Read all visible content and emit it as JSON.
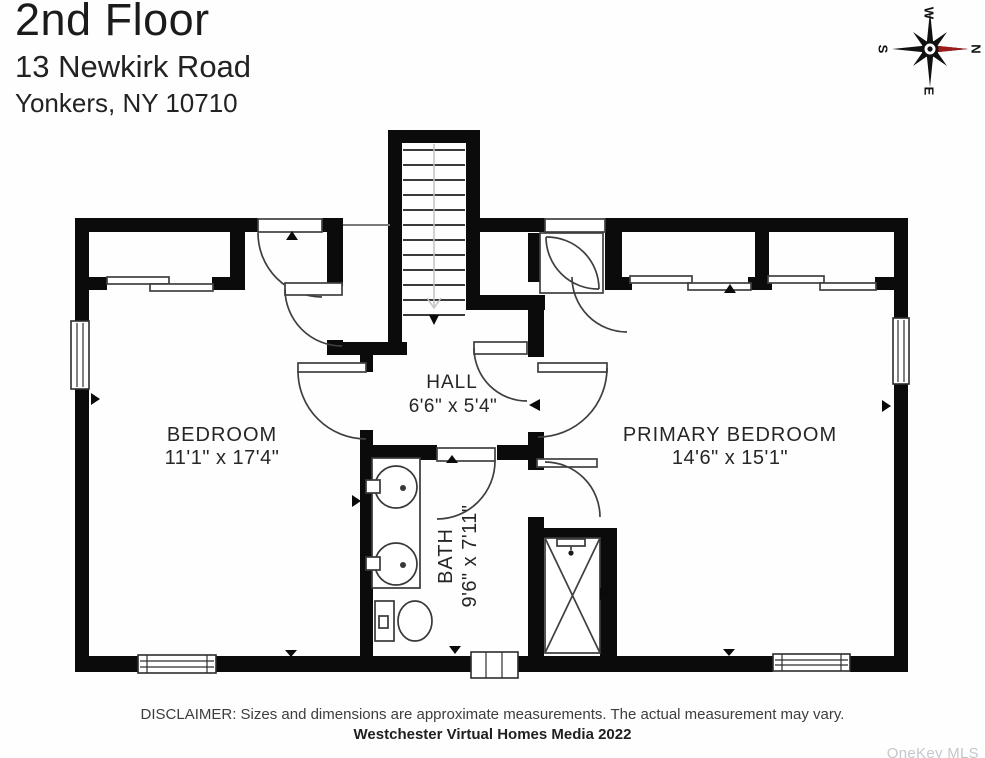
{
  "header": {
    "title": "2nd Floor",
    "address_line1": "13 Newkirk Road",
    "address_line2": "Yonkers, NY 10710"
  },
  "compass": {
    "north": "N",
    "south": "S",
    "east": "E",
    "west": "W"
  },
  "rooms": {
    "bedroom": {
      "name": "BEDROOM",
      "dims": "11'1\" x 17'4\""
    },
    "hall": {
      "name": "HALL",
      "dims": "6'6\" x 5'4\""
    },
    "primary": {
      "name": "PRIMARY BEDROOM",
      "dims": "14'6\" x 15'1\""
    },
    "bath": {
      "name": "BATH",
      "dims": "9'6\" x 7'11\""
    }
  },
  "footer": {
    "disclaimer": "DISCLAIMER: Sizes and dimensions are approximate measurements. The actual measurement may vary.",
    "credit": "Westchester Virtual Homes Media 2022"
  },
  "watermark": "OneKey MLS",
  "colors": {
    "wall": "#0b0b0b",
    "line": "#3f3f3f",
    "text": "#262626",
    "compass_red": "#9e1b1b",
    "watermark_gray": "#c3c8cd"
  }
}
